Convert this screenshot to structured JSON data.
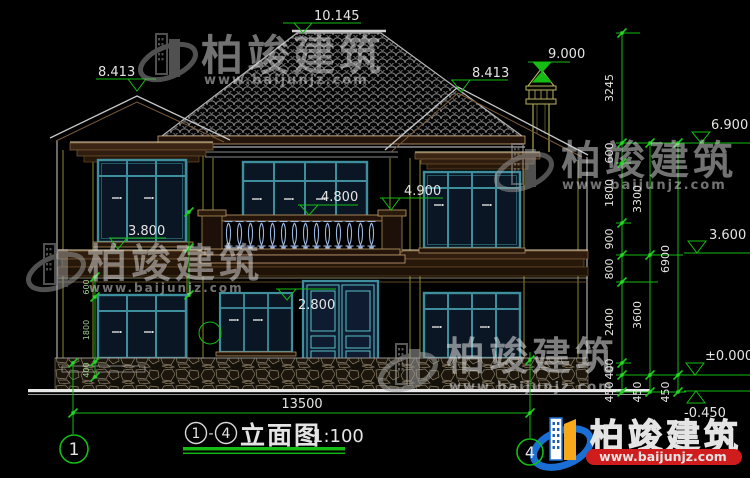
{
  "title_block": {
    "axis_from": "1",
    "separator": "-",
    "axis_to": "4",
    "name": "立面图",
    "scale": "1:100"
  },
  "axis_bubbles": {
    "left": "1",
    "right": "4"
  },
  "elevation_marks": {
    "ridge": "10.145",
    "chimney_top": "9.000",
    "roof_left": "8.413",
    "roof_right": "8.413",
    "eave": "6.900",
    "floor2_window": "4.900",
    "balcony": "4.800",
    "floor2_sill": "3.800",
    "belt": "3.600",
    "door_top": "2.800",
    "ground_zero": "±0.000",
    "site_level": "-0.450"
  },
  "dimensions": {
    "total_width": "13500",
    "right_inner": [
      "3245",
      "600",
      "1800",
      "900",
      "800",
      "2400",
      "400",
      "450"
    ],
    "right_middle": [
      "3300",
      "3600",
      "450"
    ],
    "right_outer": [
      "6900",
      "450"
    ],
    "left_chain": [
      "600",
      "1800",
      "400"
    ]
  },
  "brand": {
    "name": "柏竣建筑",
    "url": "www.baijunjz.com"
  }
}
